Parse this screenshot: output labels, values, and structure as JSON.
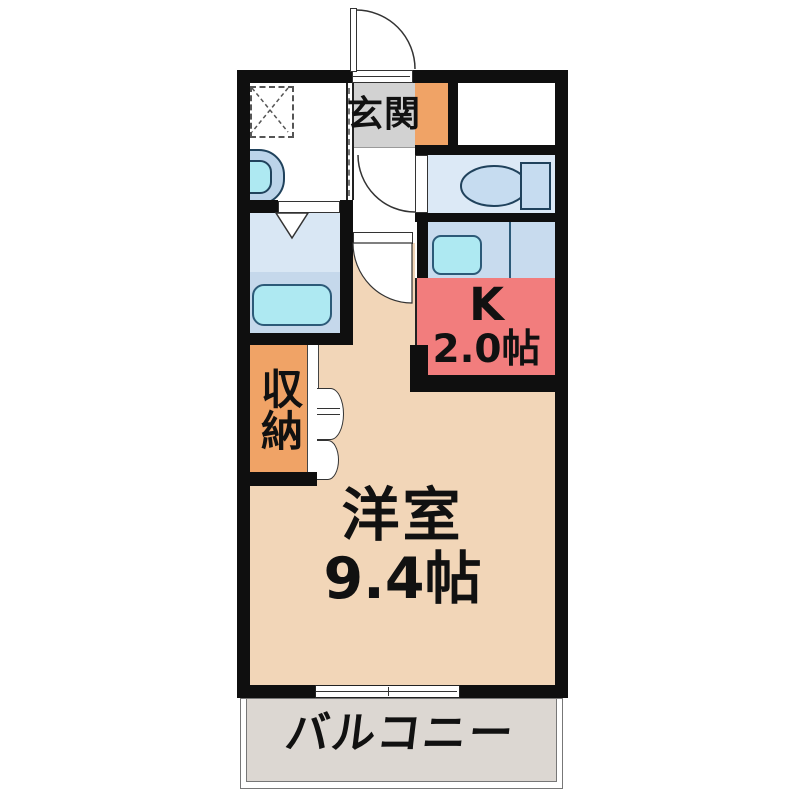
{
  "plan_title": "1K apartment floor plan",
  "rooms": {
    "genkan": {
      "label": "玄関",
      "color": "#D2D2D2"
    },
    "kitchen": {
      "label": "K",
      "size": "2.0帖",
      "color": "#F27D7D"
    },
    "storage": {
      "label": "収納",
      "color": "#F0A366"
    },
    "western_room": {
      "label": "洋室",
      "size": "9.4帖",
      "color": "#F2D6B8"
    },
    "balcony": {
      "label": "バルコニー",
      "color": "#DCD7D2"
    },
    "bathroom": {
      "color": "#D9E7F4"
    },
    "toilet": {
      "color": "#DCE9F6"
    }
  },
  "fixtures": {
    "toilet": "toilet-icon",
    "bathtub": "bathtub-icon",
    "washbasin": "washbasin-icon",
    "kitchen_sink": "kitchen-sink-icon",
    "washer_space": "washing-machine-space-icon",
    "doors": [
      "entrance-door-arc",
      "toilet-door-arc",
      "room-door-arc",
      "bathroom-folding-door",
      "closet-bifold-doors",
      "balcony-sliding-window"
    ]
  },
  "palette": {
    "wall": "#0F0F0F",
    "room_peach": "#F2D6B8",
    "kitchen_red": "#F27D7D",
    "storage_orange": "#F0A366",
    "genkan_gray": "#D2D2D2",
    "balcony_gray": "#DCD7D2",
    "counter_blue": "#C8DBEE",
    "fixture_cyan": "#AEE9F2"
  }
}
